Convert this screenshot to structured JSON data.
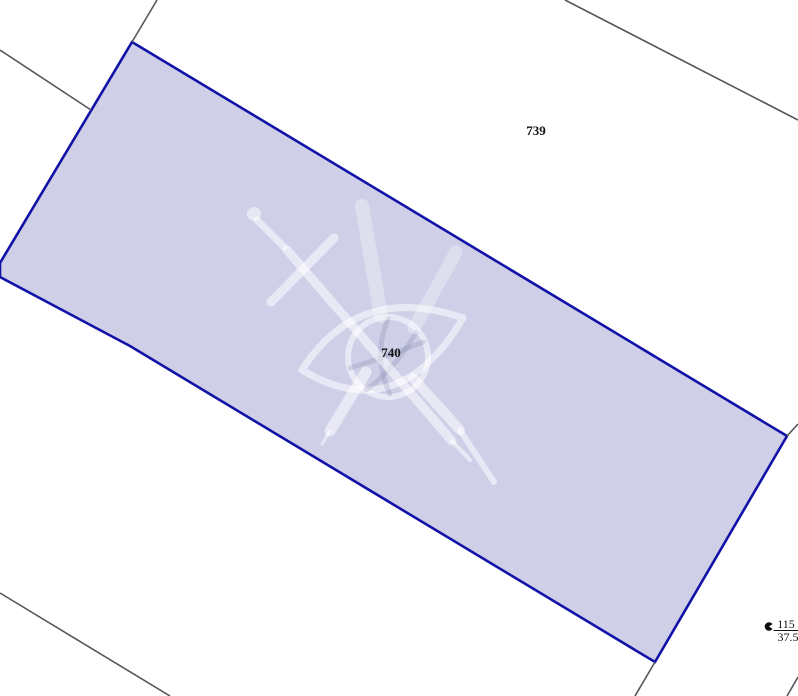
{
  "page": {
    "width": 798,
    "height": 696,
    "background": "#ffffff"
  },
  "colors": {
    "parcel_fill": "#cfcfe8",
    "parcel_stroke": "#1212a8",
    "neighbor_line": "#56565a",
    "label_text": "#111111"
  },
  "parcel_740": {
    "label": "740",
    "label_x": 391,
    "label_y": 357,
    "points": "132,42 787,436 655,662 130,346 0,277 0,263"
  },
  "parcel_739": {
    "label": "739",
    "label_x": 536,
    "label_y": 135
  },
  "boundary_lines": [
    {
      "x1": 0,
      "y1": 50,
      "x2": 91,
      "y2": 110
    },
    {
      "x1": 132,
      "y1": 42,
      "x2": 157,
      "y2": 0
    },
    {
      "x1": 565,
      "y1": 0,
      "x2": 798,
      "y2": 120
    },
    {
      "x1": 787,
      "y1": 436,
      "x2": 798,
      "y2": 424
    },
    {
      "x1": 655,
      "y1": 662,
      "x2": 635,
      "y2": 696
    },
    {
      "x1": 0,
      "y1": 593,
      "x2": 170,
      "y2": 696
    },
    {
      "x1": 798,
      "y1": 677,
      "x2": 787,
      "y2": 696
    }
  ],
  "survey_point": {
    "numerator": "115",
    "denominator": "37.5",
    "symbol_x": 769,
    "symbol_y": 626.5,
    "num_x": 786,
    "num_y": 628,
    "den_x": 788,
    "den_y": 641,
    "line_x1": 773.5,
    "line_y1": 630.5,
    "line_x2": 798,
    "line_y2": 630.5
  },
  "watermark": {
    "name": "surveyor-eye-globe-compass-logo"
  }
}
